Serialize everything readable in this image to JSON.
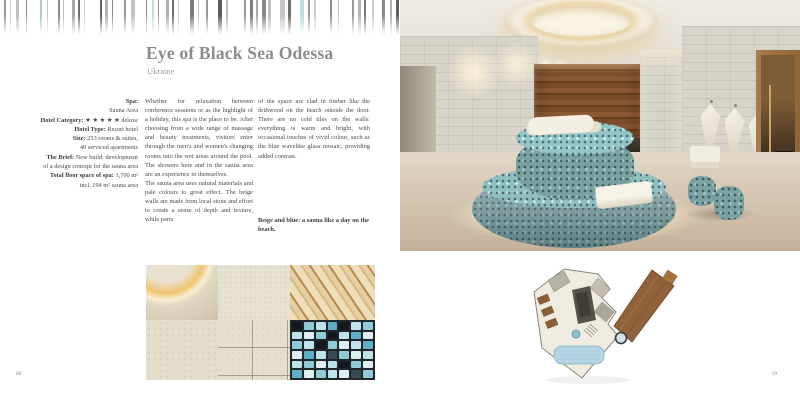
{
  "pages": {
    "left_number": "68",
    "right_number": "69"
  },
  "header": {
    "title": "Eye of Black Sea Odessa",
    "subtitle": "Ukraine"
  },
  "facts": {
    "lines": [
      {
        "b": "Spa:",
        "t": ""
      },
      {
        "b": "",
        "t": "Sauna Area"
      },
      {
        "b": "Hotel Category:",
        "t": "★ ★ ★ ★ ★ deluxe"
      },
      {
        "b": "Hotel Type:",
        "t": "Resort hotel"
      },
      {
        "b": "Size:",
        "t": "253 rooms & suites,"
      },
      {
        "b": "",
        "t": "40 serviced apartments"
      },
      {
        "b": "The Brief:",
        "t": "New build: development"
      },
      {
        "b": "",
        "t": "of a design concept for the sauna area"
      },
      {
        "b": "Total floor space of spa:",
        "t": "1,700 m²"
      },
      {
        "b": "",
        "t": "incl. 194 m² sauna area"
      }
    ]
  },
  "body": {
    "column1_para1": "Whether for relaxation between conference sessions or as the highlight of a holiday, this spa is the place to be. After choosing from a wide range of massage and beauty treatments, visitors enter through the men's and women's changing rooms into the wet areas around the pool. The showers here and in the sauna area are an experience in themselves.",
    "column1_para2": "The sauna area uses natural materials and pale colours to great effect. The beige walls are made from local stone and effort to create a sense of depth and texture, while parts",
    "column2_para": "of the space are clad in timber like the driftwood on the beach outside the door. There are no cold tiles on the walls: everything is warm and bright, with occasional touches of vivid colour, such as the blue wavelike glass mosaic, providing added contrast.",
    "caption": "Beige and blue: a sauna like a day on the beach."
  },
  "images": {
    "main_photo": "sauna-area-with-round-mosaic-lounger",
    "collage_tiles": [
      "ceiling-ring-light",
      "beige-stone",
      "wood-slats",
      "beige-stone-rough",
      "stone-tiles",
      "blue-glass-mosaic"
    ],
    "floor_plan": "spa-floor-plan"
  },
  "colors": {
    "title_gray": "#8c8c8c",
    "accent_mosaic_teal": "#7aa2a3",
    "wood_brown": "#7a4f2c",
    "stone_wall": "#d8d4c9",
    "floor_beige": "#d6c6b0",
    "plan_pool_blue": "#b5d4e4",
    "barcode_teal": "#b9dedd"
  },
  "decor": {
    "barcode_bars": [
      {
        "x": 4,
        "w": 2,
        "c": "#9a9a9a"
      },
      {
        "x": 10,
        "w": 1,
        "c": "#cccccc"
      },
      {
        "x": 16,
        "w": 3,
        "c": "#bfbfbf"
      },
      {
        "x": 26,
        "w": 1,
        "c": "#8f8f8f"
      },
      {
        "x": 40,
        "w": 2,
        "c": "#9fd2cf"
      },
      {
        "x": 47,
        "w": 1,
        "c": "#c8c8c8"
      },
      {
        "x": 58,
        "w": 2,
        "c": "#8a8a8a"
      },
      {
        "x": 63,
        "w": 1,
        "c": "#bdbdbd"
      },
      {
        "x": 72,
        "w": 3,
        "c": "#a9a9a9"
      },
      {
        "x": 78,
        "w": 2,
        "c": "#6e6e6e"
      },
      {
        "x": 84,
        "w": 1,
        "c": "#cfcfcf"
      },
      {
        "x": 100,
        "w": 2,
        "c": "#5f5f5f"
      },
      {
        "x": 105,
        "w": 3,
        "c": "#b5b5b5"
      },
      {
        "x": 112,
        "w": 1,
        "c": "#8a8a8a"
      },
      {
        "x": 124,
        "w": 2,
        "c": "#9a9a9a"
      },
      {
        "x": 131,
        "w": 4,
        "c": "#c4c4c4"
      },
      {
        "x": 146,
        "w": 1,
        "c": "#8f8f8f"
      },
      {
        "x": 152,
        "w": 2,
        "c": "#c2e0de"
      },
      {
        "x": 158,
        "w": 1,
        "c": "#9a9a9a"
      },
      {
        "x": 166,
        "w": 3,
        "c": "#b0b0b0"
      },
      {
        "x": 172,
        "w": 2,
        "c": "#6b6b6b"
      },
      {
        "x": 178,
        "w": 1,
        "c": "#cccccc"
      },
      {
        "x": 190,
        "w": 4,
        "c": "#7a7a7a"
      },
      {
        "x": 198,
        "w": 1,
        "c": "#bdbdbd"
      },
      {
        "x": 206,
        "w": 2,
        "c": "#9a9a9a"
      },
      {
        "x": 218,
        "w": 4,
        "c": "#5c5c5c"
      },
      {
        "x": 226,
        "w": 2,
        "c": "#b9b9b9"
      },
      {
        "x": 244,
        "w": 2,
        "c": "#9a9a9a"
      },
      {
        "x": 250,
        "w": 3,
        "c": "#7d7d7d"
      },
      {
        "x": 256,
        "w": 2,
        "c": "#a9a9a9"
      },
      {
        "x": 262,
        "w": 4,
        "c": "#8a8a8a"
      },
      {
        "x": 268,
        "w": 3,
        "c": "#bdbdbd"
      },
      {
        "x": 280,
        "w": 5,
        "c": "#c6c6c6"
      },
      {
        "x": 288,
        "w": 3,
        "c": "#6e6e6e"
      },
      {
        "x": 300,
        "w": 4,
        "c": "#b9dedd"
      },
      {
        "x": 308,
        "w": 2,
        "c": "#9a9a9a"
      },
      {
        "x": 314,
        "w": 2,
        "c": "#cfcfcf"
      },
      {
        "x": 330,
        "w": 2,
        "c": "#8f8f8f"
      },
      {
        "x": 338,
        "w": 1,
        "c": "#c4c4c4"
      },
      {
        "x": 352,
        "w": 2,
        "c": "#9a9a9a"
      },
      {
        "x": 358,
        "w": 3,
        "c": "#b5b5b5"
      },
      {
        "x": 364,
        "w": 2,
        "c": "#777777"
      },
      {
        "x": 372,
        "w": 2,
        "c": "#cccccc"
      },
      {
        "x": 382,
        "w": 3,
        "c": "#8a8a8a"
      },
      {
        "x": 390,
        "w": 2,
        "c": "#b0b0b0"
      },
      {
        "x": 396,
        "w": 3,
        "c": "#5f5f5f"
      }
    ]
  },
  "collage": {
    "mosaic_palette": [
      "#bfe3ea",
      "#8fccd8",
      "#5fb0c6",
      "#15181c",
      "#dcf0f2",
      "#3a4a52",
      "#a7dae2"
    ],
    "mosaic_rows": [
      [
        3,
        1,
        0,
        2,
        3,
        0,
        1
      ],
      [
        0,
        4,
        1,
        3,
        0,
        2,
        4
      ],
      [
        1,
        0,
        3,
        1,
        4,
        0,
        2
      ],
      [
        4,
        2,
        0,
        5,
        1,
        4,
        0
      ],
      [
        0,
        1,
        4,
        0,
        3,
        1,
        4
      ],
      [
        2,
        4,
        1,
        0,
        4,
        5,
        1
      ]
    ]
  }
}
